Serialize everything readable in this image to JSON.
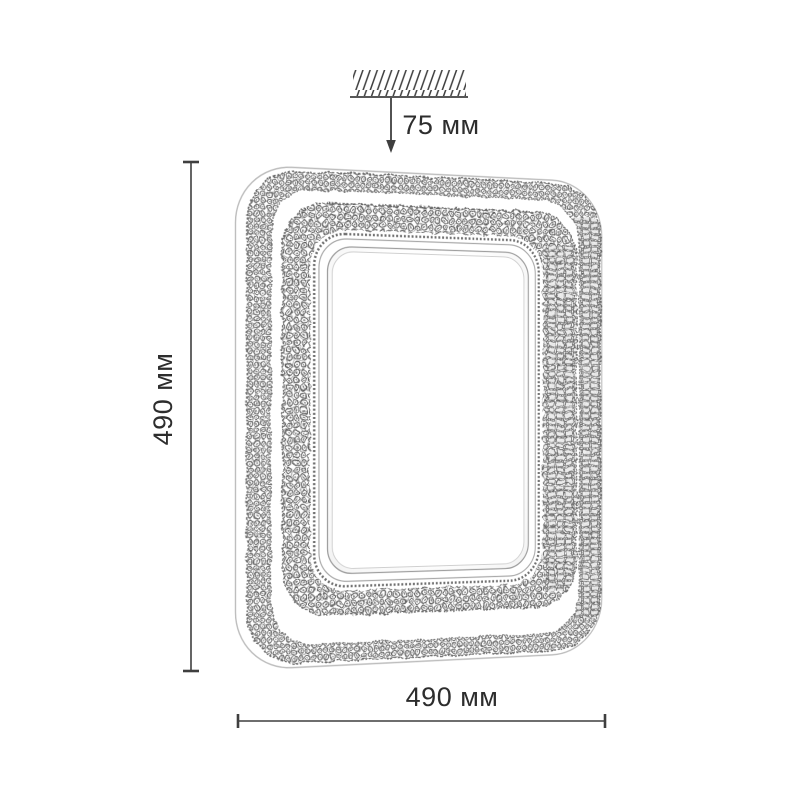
{
  "diagram": {
    "kind": "product-dimension-drawing",
    "units": "мм",
    "annotations": {
      "mount_distance": {
        "value": "75 мм",
        "position": "top"
      },
      "height": {
        "value": "490 мм",
        "position": "left",
        "orientation": "vertical"
      },
      "width": {
        "value": "490 мм",
        "position": "bottom",
        "orientation": "horizontal"
      }
    },
    "icons": {
      "ceiling": "ceiling-hatch-icon",
      "arrow": "down-arrow-icon"
    },
    "colors": {
      "line": "#3f3f3f",
      "text": "#2d2d2d",
      "texture_dark": "#585858",
      "texture_mid": "#7a7a7a",
      "contour": "#bdbdbd",
      "background": "#ffffff"
    }
  }
}
